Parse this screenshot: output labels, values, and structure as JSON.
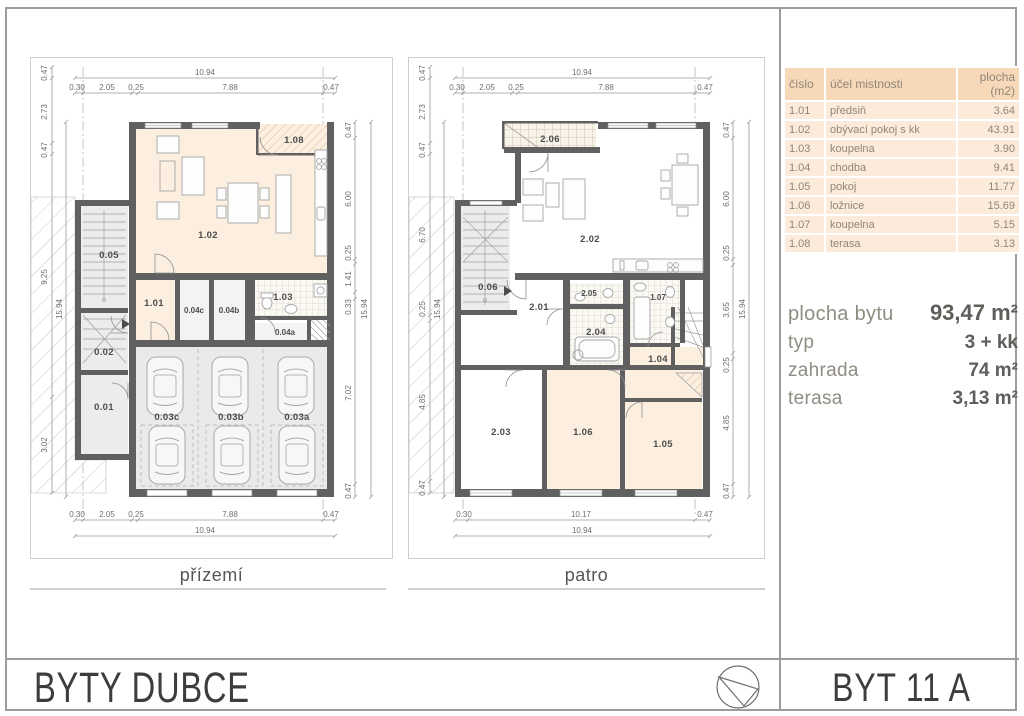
{
  "panel": {
    "table": {
      "headers": {
        "cislo": "číslo",
        "ucel": "účel mistnosti",
        "plocha_line1": "plocha",
        "plocha_line2": "(m2)"
      },
      "rows": [
        {
          "cislo": "1.01",
          "ucel": "předsiň",
          "plocha": "3.64"
        },
        {
          "cislo": "1.02",
          "ucel": "obývací pokoj s kk",
          "plocha": "43.91"
        },
        {
          "cislo": "1.03",
          "ucel": "koupelna",
          "plocha": "3.90"
        },
        {
          "cislo": "1.04",
          "ucel": "chodba",
          "plocha": "9.41"
        },
        {
          "cislo": "1.05",
          "ucel": "pokoj",
          "plocha": "11.77"
        },
        {
          "cislo": "1.06",
          "ucel": "ložnice",
          "plocha": "15.69"
        },
        {
          "cislo": "1.07",
          "ucel": "koupelna",
          "plocha": "5.15"
        },
        {
          "cislo": "1.08",
          "ucel": "terasa",
          "plocha": "3.13"
        }
      ]
    },
    "info": {
      "rows": [
        {
          "label": "plocha bytu",
          "value": "93,47 m²"
        },
        {
          "label": "typ",
          "value": "3 + kk"
        },
        {
          "label": "zahrada",
          "value": "74 m²"
        },
        {
          "label": "terasa",
          "value": "3,13 m²"
        }
      ]
    }
  },
  "footer": {
    "project": "BYTY DUBCE",
    "unit": "BYT 11 A",
    "north_icon": "compass-north-arrow"
  },
  "plans": {
    "prizemi": {
      "title": "přízemí",
      "rooms": {
        "r108": "1.08",
        "r102": "1.02",
        "r005": "0.05",
        "r101": "1.01",
        "r004c": "0.04c",
        "r004b": "0.04b",
        "r103": "1.03",
        "r004a": "0.04a",
        "r002": "0.02",
        "r001": "0.01",
        "r003c": "0.03c",
        "r003b": "0.03b",
        "r003a": "0.03a"
      },
      "dims": {
        "top_total": "10.94",
        "top": [
          "0.30",
          "2.05",
          "0.25",
          "7.88",
          "0.47"
        ],
        "bottom": [
          "0.30",
          "2.05",
          "0.25",
          "7.88",
          "0.47"
        ],
        "bottom_total": "10.94",
        "left": [
          "0.47",
          "2.73",
          "0.47",
          "9.25",
          "3.02"
        ],
        "left_total": "15.94",
        "right": [
          "0.47",
          "6.00",
          "0.25",
          "1.41",
          "0.33",
          "7.02",
          "0.47"
        ],
        "right_total": "15.94"
      }
    },
    "patro": {
      "title": "patro",
      "rooms": {
        "r206": "2.06",
        "r202": "2.02",
        "r006": "0.06",
        "r201": "2.01",
        "r205": "2.05",
        "r204": "2.04",
        "r107": "1.07",
        "r104": "1.04",
        "r203": "2.03",
        "r106": "1.06",
        "r105": "1.05"
      },
      "dims": {
        "top_total": "10.94",
        "top": [
          "0.30",
          "2.05",
          "0.25",
          "7.88",
          "0.47"
        ],
        "bottom": [
          "0.30",
          "10.17",
          "0.47"
        ],
        "bottom_total": "10.94",
        "left": [
          "0.47",
          "2.73",
          "0.47",
          "6.70",
          "0.25",
          "4.85",
          "0.47"
        ],
        "left_total": "15.94",
        "right": [
          "0.47",
          "6.00",
          "0.25",
          "3.65",
          "0.25",
          "4.85",
          "0.47"
        ],
        "right_total": "15.94"
      }
    }
  }
}
